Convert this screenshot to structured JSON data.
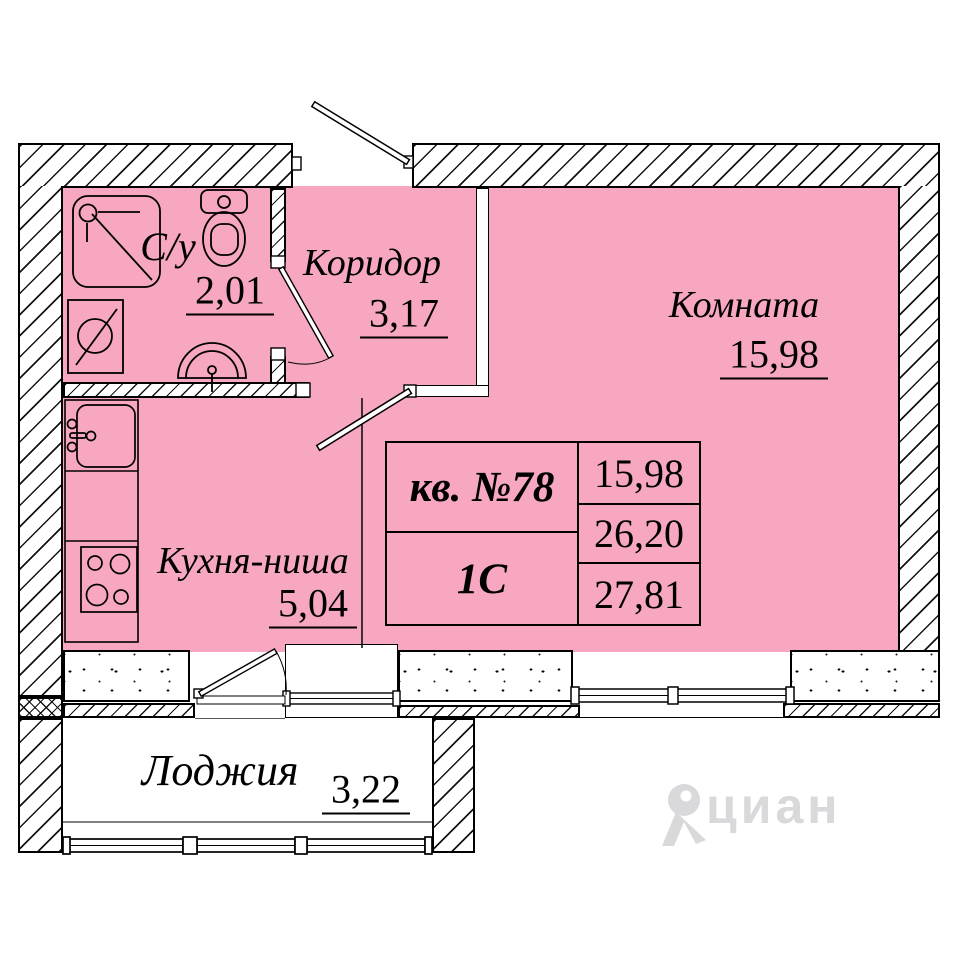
{
  "plan": {
    "rooms": [
      {
        "id": "bathroom",
        "name": "С/у",
        "area": "2,01"
      },
      {
        "id": "corridor",
        "name": "Коридор",
        "area": "3,17"
      },
      {
        "id": "room",
        "name": "Комната",
        "area": "15,98"
      },
      {
        "id": "kitchen",
        "name": "Кухня-ниша",
        "area": "5,04"
      },
      {
        "id": "loggia",
        "name": "Лоджия",
        "area": "3,22"
      }
    ],
    "info_table": {
      "apartment": "кв. №78",
      "type": "1С",
      "values": [
        "15,98",
        "26,20",
        "27,81"
      ]
    },
    "watermark": "циан",
    "colors": {
      "room_fill": "#f7a7c0",
      "line": "#000000",
      "watermark": "#d9d9db"
    }
  }
}
